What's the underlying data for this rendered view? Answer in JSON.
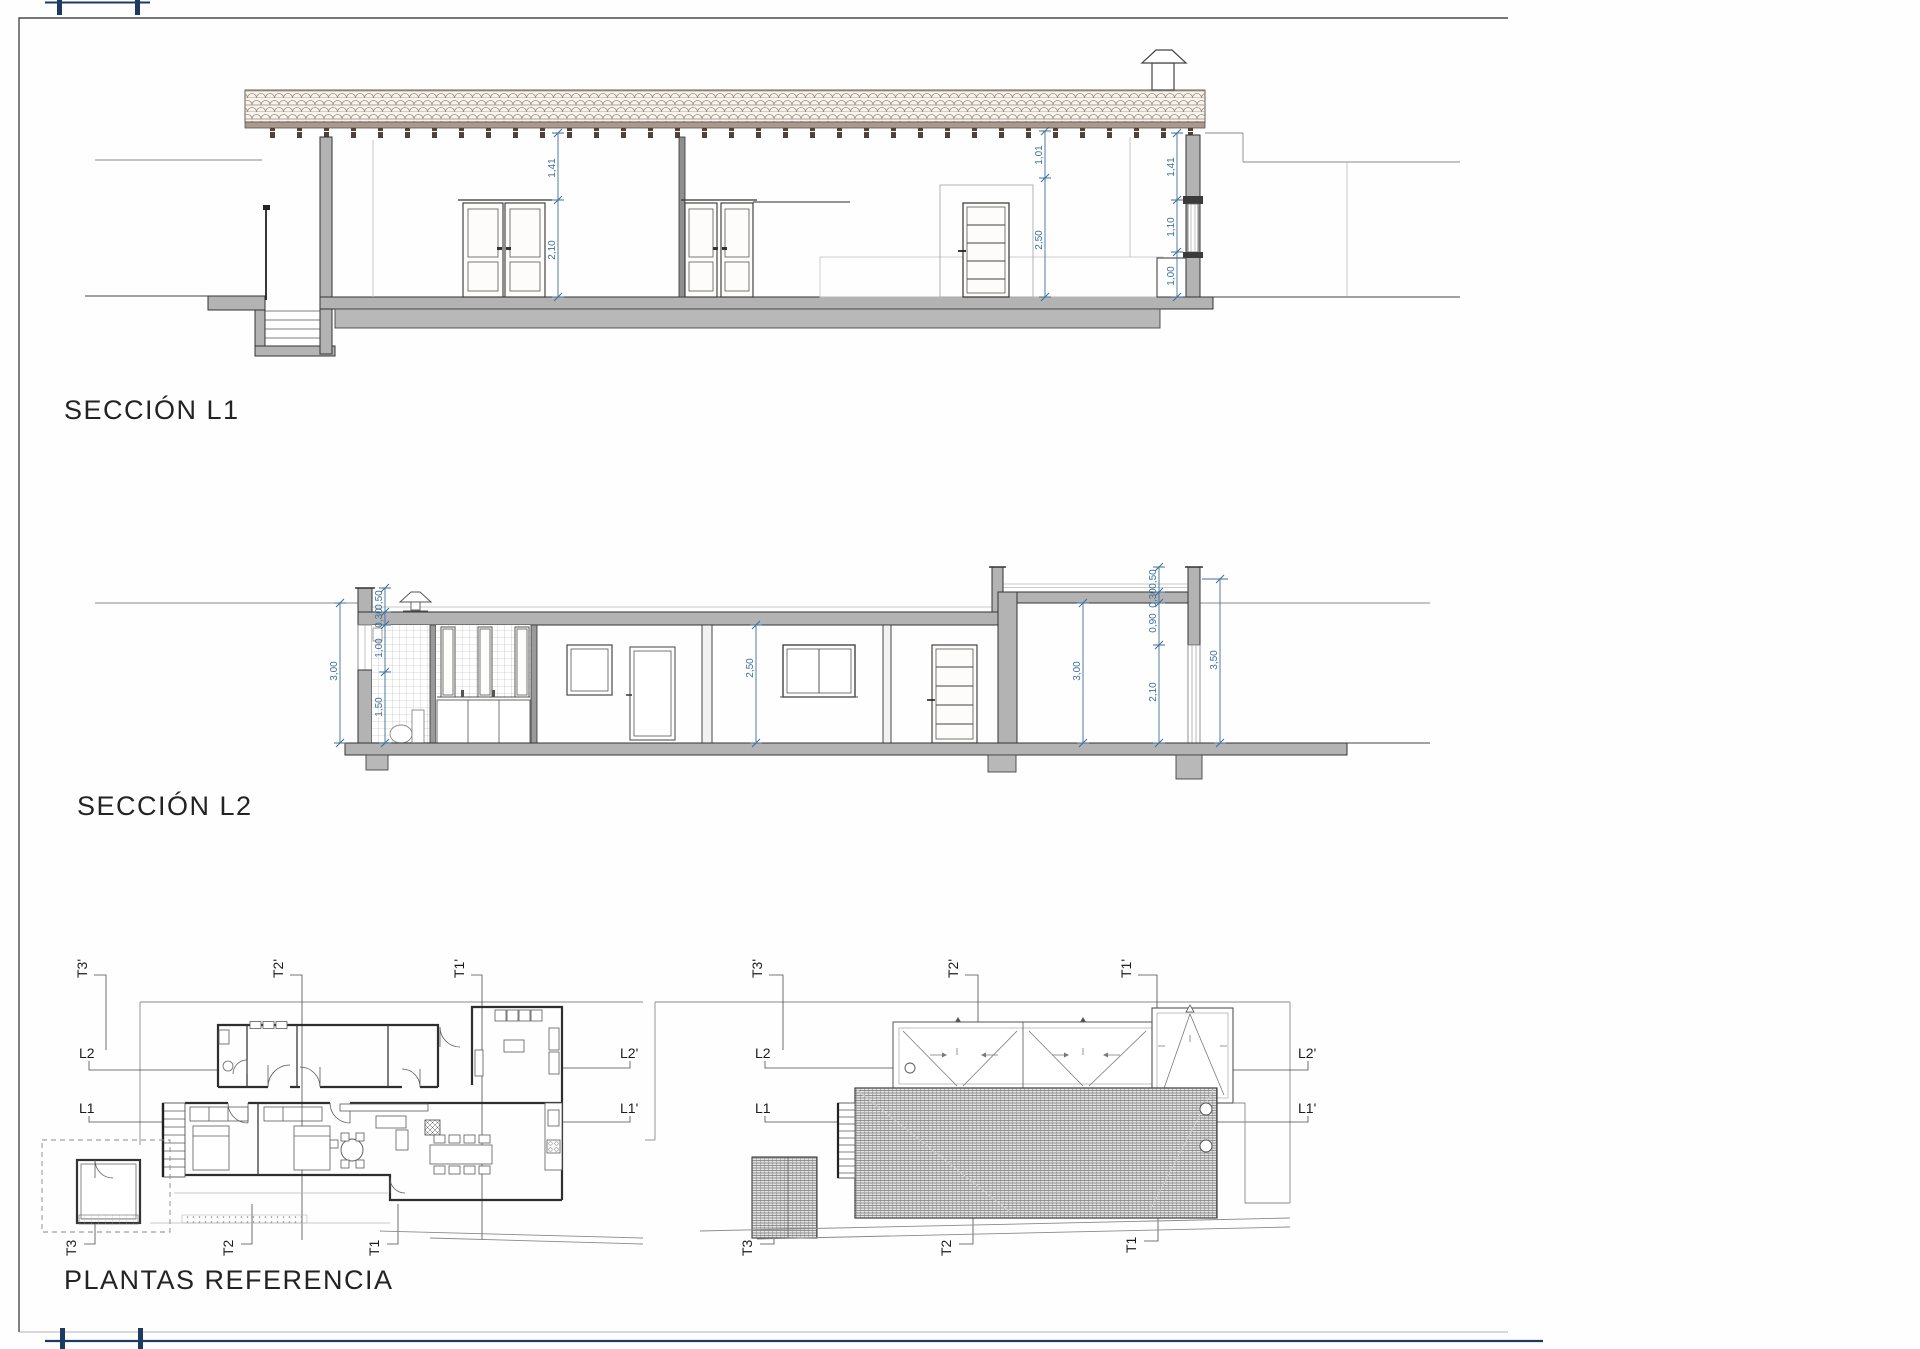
{
  "sheet": {
    "background": "#fefefe",
    "border_color": "#555555",
    "registration_mark_color": "#1c3b63",
    "dimension_color": "#3f6e99",
    "wall_fill_color": "#b3b3b3",
    "roof_tile_color": "#9b8a7a"
  },
  "sections": {
    "l1": {
      "title": "SECCIÓN L1",
      "dims": {
        "door_head_to_roof": "1,41",
        "door_height": "2,10",
        "mid_head_to_roof": "1,01",
        "mid_room_height": "2,50",
        "right_wall_top": "1,41",
        "right_window": "1,10",
        "right_sill": "1,00"
      }
    },
    "l2": {
      "title": "SECCIÓN L2",
      "dims": {
        "left_outer": "3,00",
        "left_parapet": "0,50",
        "left_slab": "0,30",
        "left_window": "1,00",
        "left_lower": "1,50",
        "room_height": "2,50",
        "tall_room_height": "3,00",
        "right_parapet": "0,50",
        "right_slab": "0,30",
        "right_beam": "0,90",
        "right_door": "2,10",
        "right_outer": "3,50"
      }
    },
    "plans": {
      "title": "PLANTAS REFERENCIA",
      "labels": {
        "t3p": "T3'",
        "t2p": "T2'",
        "t1p": "T1'",
        "l2": "L2",
        "l1": "L1",
        "l2p": "L2'",
        "l1p": "L1'",
        "t3": "T3",
        "t2": "T2",
        "t1": "T1"
      }
    }
  }
}
